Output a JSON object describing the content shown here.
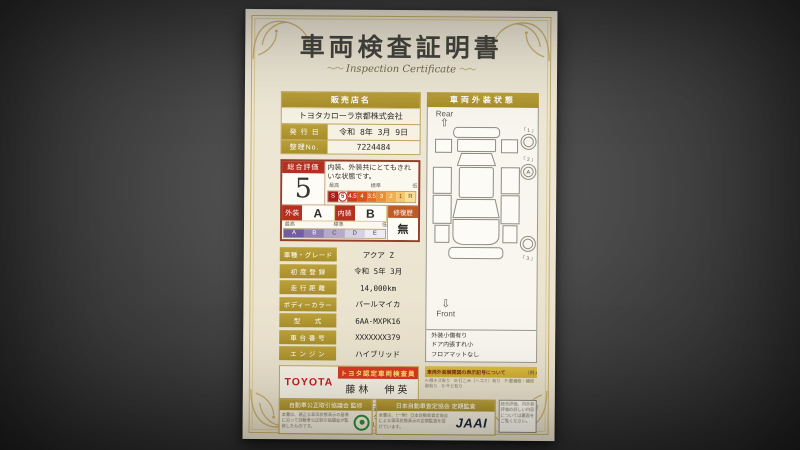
{
  "doc": {
    "title": "車両検査証明書",
    "subtitle": "Inspection Certificate",
    "ornament_left": "〜〜",
    "ornament_right": "〜〜",
    "dealer": {
      "header": "販売店名",
      "name": "トヨタカローラ京都株式会社",
      "issue_label": "発 行 日",
      "issue_value": "令和 8年 3月 9日",
      "serial_label": "整理No.",
      "serial_value": "7224484"
    },
    "eval": {
      "overall_label": "総合評価",
      "overall_grade": "5",
      "comment": "内装、外装共にとてもきれいな状態です。",
      "scale_high": "最高",
      "scale_standard": "標準",
      "scale_low": "低",
      "grade_scale": [
        "S",
        "5",
        "4.5",
        "4",
        "3.5",
        "3",
        "2",
        "1",
        "R"
      ],
      "exterior_label": "外装",
      "exterior_grade": "A",
      "interior_label": "内装",
      "interior_grade": "B",
      "letter_scale": [
        "A",
        "B",
        "C",
        "D",
        "E"
      ],
      "repair_label": "修復歴",
      "repair_value": "無"
    },
    "details": [
      {
        "label": "車種・グレード",
        "value": "アクア Z"
      },
      {
        "label": "初 度 登 録",
        "value": "令和 5年 3月"
      },
      {
        "label": "走 行 距 離",
        "value": "14,000km"
      },
      {
        "label": "ボディーカラー",
        "value": "パールマイカ"
      },
      {
        "label": "型　　式",
        "value": "6AA-MXPK16"
      },
      {
        "label": "車 台 番 号",
        "value": "XXXXXXX379"
      },
      {
        "label": "エ ン ジ ン",
        "value": "ハイブリッド"
      }
    ],
    "inspector": {
      "brand": "TOYOTA",
      "cert_title": "トヨタ認定車両検査員",
      "name": "藤林　伸英"
    },
    "disclaimer": "当車両は、自動車オークションで適用される車両評価基準に沿い、トヨタユーゼックが認定した検査員が厳正に検査・評価いたしました。",
    "exterior": {
      "header": "車両外装状態",
      "rear_label": "Rear",
      "front_label": "Front",
      "wheel_labels": [
        "「 1 」",
        "「 2 」",
        "「 3 」"
      ],
      "wheel_mark": "A",
      "notes": [
        "外装小傷有り",
        "ドア内張すれ小",
        "フロアマットなし"
      ]
    },
    "legend": {
      "header": "車両外装展開図の表示記号について",
      "example": "（例:A1） 線キズの程度等の場合",
      "lines": [
        "A-線キズ有り　B-打こみ（ヘコミ）有り　P-要補修・補修跡有り　S-サビ有り",
        "X-要交換（飛び石等の軽度有り）　XX-交換済　2-中程度有り　3-強度有り"
      ]
    },
    "footer": {
      "fair_trade_title": "自動車公正取引協議会 監修",
      "fair_trade_body": "本書は、適正な車両状態表示の基準に沿って自動車公正取引協議会が監修したものです。",
      "assessor_title": "日本自動車査定協会 定期監査",
      "assessor_body": "本書は、（一財）日本自動車査定協会による車両状態表示の定期監査を受けています。",
      "jaai": "JAAI",
      "back_note": "総合評価、内外装評価の詳しい内容については裏面をご覧ください。"
    }
  }
}
